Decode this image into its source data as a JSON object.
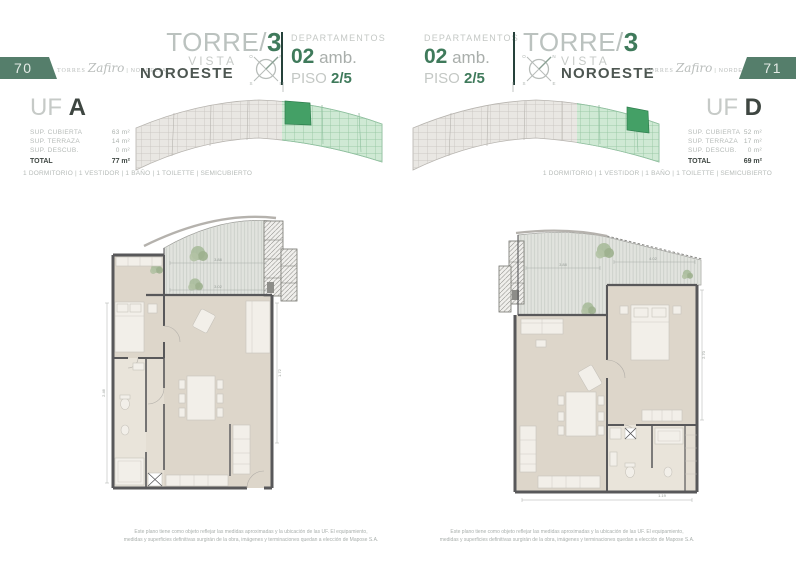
{
  "theme": {
    "accent_green": "#3f7a5b",
    "page_box_green": "#557e6b",
    "site_green_light": "#cfe9d4",
    "site_green_dark": "#44a066",
    "text_light": "#c4c8c5",
    "text_dark": "#4d5651",
    "wall_color": "#58585a",
    "floor_color": "#ddd6ca"
  },
  "compass": {
    "n": "N",
    "e": "E",
    "s": "S",
    "o": "O"
  },
  "disclaimer": {
    "line1": "Este plano tiene como objeto reflejar las medidas aproximadas y la ubicación de las UF. El equipamiento,",
    "line2": "medidas y superficies definitivas surgirán de la obra, imágenes y terminaciones quedan a elección de Mapose S.A."
  },
  "pages": {
    "left": {
      "page_number": "70",
      "brand": {
        "prefix": "TORRES",
        "name": "Zafiro",
        "suffix": "| NORDELTA"
      },
      "tower": {
        "title": "TORRE/",
        "number": "3",
        "vista": "VISTA",
        "orientation": "NOROESTE"
      },
      "dept": {
        "label": "DEPARTAMENTOS",
        "amb_num": "02",
        "amb_text": "amb.",
        "piso_label": "PISO",
        "piso_value": "2/5"
      },
      "unit": {
        "uf": "UF",
        "letter": "A",
        "rows": [
          {
            "label": "SUP. CUBIERTA",
            "value": "63 m²"
          },
          {
            "label": "SUP. TERRAZA",
            "value": "14 m²"
          },
          {
            "label": "SUP. DESCUB.",
            "value": "0 m²"
          }
        ],
        "total_label": "TOTAL",
        "total_value": "77 m²"
      },
      "amenities": "1 DORMITORIO | 1 VESTIDOR | 1 BAÑO | 1 TOILETTE | SEMICUBIERTO",
      "plan_dims": {
        "d1": "3.88",
        "d2": "3.02",
        "d3": "2.46",
        "d4": "1.72"
      }
    },
    "right": {
      "page_number": "71",
      "brand": {
        "prefix": "TORRES",
        "name": "Zafiro",
        "suffix": "| NORDELTA"
      },
      "tower": {
        "title": "TORRE/",
        "number": "3",
        "vista": "VISTA",
        "orientation": "NOROESTE"
      },
      "dept": {
        "label": "DEPARTAMENTOS",
        "amb_num": "02",
        "amb_text": "amb.",
        "piso_label": "PISO",
        "piso_value": "2/5"
      },
      "unit": {
        "uf": "UF",
        "letter": "D",
        "rows": [
          {
            "label": "SUP. CUBIERTA",
            "value": "52 m²"
          },
          {
            "label": "SUP. TERRAZA",
            "value": "17 m²"
          },
          {
            "label": "SUP. DESCUB.",
            "value": "0 m²"
          }
        ],
        "total_label": "TOTAL",
        "total_value": "69 m²"
      },
      "amenities": "1 DORMITORIO | 1 VESTIDOR | 1 BAÑO | 1 TOILETTE | SEMICUBIERTO",
      "plan_dims": {
        "d1": "4.02",
        "d2": "3.88",
        "d3": "2.70",
        "d4": "1.19"
      }
    }
  }
}
